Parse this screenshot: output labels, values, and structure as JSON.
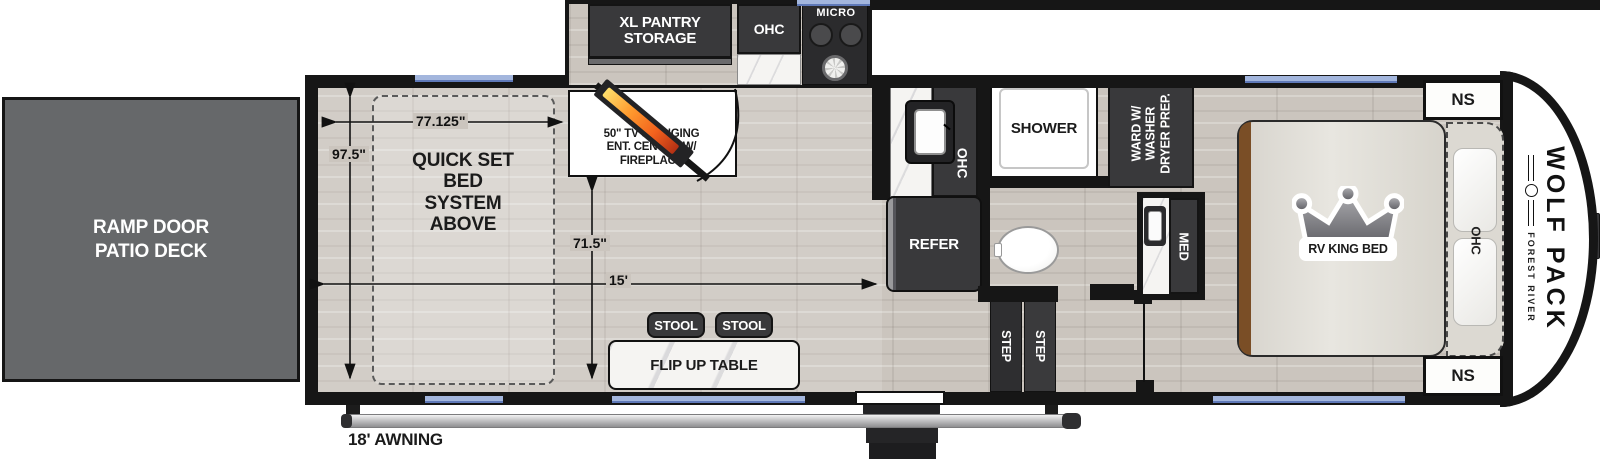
{
  "colors": {
    "wall": "#161616",
    "cabinet_dark": "#39393b",
    "window_blue": "#a3b6dd",
    "ramp_gray": "#66686a",
    "floor": "#cbc5be",
    "flame_orange": "#f2611d"
  },
  "exterior": {
    "ramp_door_label": "RAMP DOOR\nPATIO DECK",
    "awning_label": "18' AWNING"
  },
  "garage": {
    "bed_label": "QUICK SET\nBED\nSYSTEM\nABOVE",
    "dim_width": "77.125\"",
    "dim_depth": "97.5\"",
    "dim_interior": "71.5\"",
    "dim_length": "15'",
    "tv_label": "50\" TV SWINGING\nENT. CENTER W/\nFIREPLACE",
    "stool1": "STOOL",
    "stool2": "STOOL",
    "table_label": "FLIP UP TABLE"
  },
  "kitchen": {
    "pantry_label": "XL PANTRY\nSTORAGE",
    "ohc_slide": "OHC",
    "micro_label": "MICRO",
    "ohc_sink": "OHC",
    "refer_label": "REFER"
  },
  "bath": {
    "shower_label": "SHOWER",
    "ward_label": "WARD W/\nWASHER\nDRYER PREP.",
    "med_label": "MED",
    "step1": "STEP",
    "step2": "STEP"
  },
  "bedroom": {
    "bed_label": "RV KING BED",
    "ohc_label": "OHC",
    "ns_top": "NS",
    "ns_bottom": "NS"
  },
  "brand": {
    "model": "WOLF PACK",
    "manufacturer": "FOREST RIVER"
  }
}
